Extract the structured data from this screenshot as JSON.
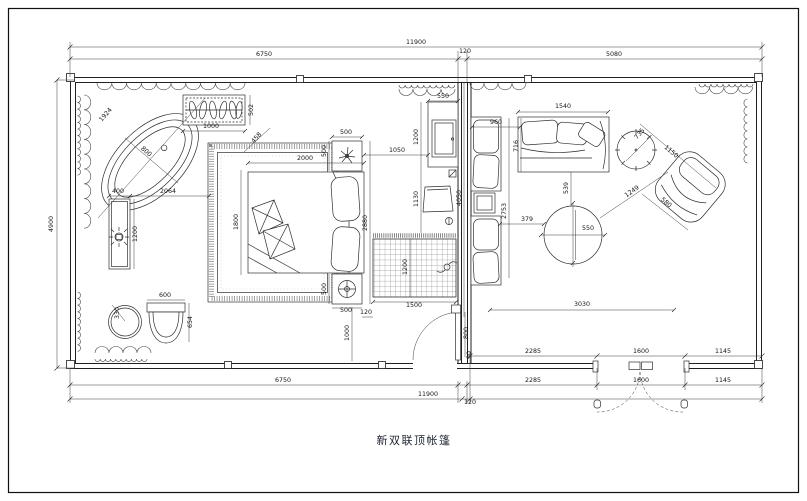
{
  "drawing": {
    "title": "新双联顶帐篷",
    "type": "floor-plan"
  },
  "colors": {
    "line": "#232323",
    "dim_text": "#141414",
    "texture": "#8a8a8a",
    "background": "#ffffff"
  },
  "icons": {
    "lamp": "circle-cross",
    "plant": "leaf-burst",
    "faucet": "sparkle",
    "ceiling-fan": "circle-blades",
    "drain": "small-circle",
    "outlet": "small-square",
    "floor-socket": "small-circle"
  },
  "overall_dimensions": {
    "total_width": "11900",
    "left_unit": "6750",
    "gap": "120",
    "right_unit": "5080",
    "depth": "4900"
  },
  "dimension_labels": [
    {
      "t": "11900",
      "x": 416,
      "y": 44,
      "r": 0
    },
    {
      "t": "6750",
      "x": 264,
      "y": 56,
      "r": 0
    },
    {
      "t": "120",
      "x": 465,
      "y": 53,
      "r": 0
    },
    {
      "t": "5080",
      "x": 614,
      "y": 56,
      "r": 0
    },
    {
      "t": "4900",
      "x": 53,
      "y": 224,
      "r": -90
    },
    {
      "t": "2285",
      "x": 533,
      "y": 353,
      "r": 0
    },
    {
      "t": "1600",
      "x": 641,
      "y": 353,
      "r": 0
    },
    {
      "t": "1145",
      "x": 723,
      "y": 353,
      "r": 0
    },
    {
      "t": "6750",
      "x": 283,
      "y": 382,
      "r": 0
    },
    {
      "t": "2285",
      "x": 533,
      "y": 382,
      "r": 0
    },
    {
      "t": "1600",
      "x": 641,
      "y": 382,
      "r": 0
    },
    {
      "t": "1145",
      "x": 723,
      "y": 382,
      "r": 0
    },
    {
      "t": "11900",
      "x": 428,
      "y": 396,
      "r": 0
    },
    {
      "t": "120",
      "x": 470,
      "y": 404,
      "r": 0
    },
    {
      "t": "1924",
      "x": 107,
      "y": 116,
      "r": -49
    },
    {
      "t": "800",
      "x": 145,
      "y": 153,
      "r": 41
    },
    {
      "t": "1000",
      "x": 211,
      "y": 128,
      "r": 0
    },
    {
      "t": "502",
      "x": 253,
      "y": 110,
      "r": -90
    },
    {
      "t": "400",
      "x": 118,
      "y": 193,
      "r": 0
    },
    {
      "t": "2064",
      "x": 168,
      "y": 193,
      "r": 0
    },
    {
      "t": "1200",
      "x": 137,
      "y": 234,
      "r": -90
    },
    {
      "t": "330",
      "x": 119,
      "y": 313,
      "r": -90
    },
    {
      "t": "600",
      "x": 165,
      "y": 297,
      "r": 0
    },
    {
      "t": "654",
      "x": 192,
      "y": 322,
      "r": -90
    },
    {
      "t": "1800",
      "x": 238,
      "y": 222,
      "r": -90
    },
    {
      "t": "458",
      "x": 258,
      "y": 139,
      "r": -49
    },
    {
      "t": "2000",
      "x": 305,
      "y": 160,
      "r": 0
    },
    {
      "t": "500",
      "x": 346,
      "y": 134,
      "r": 0
    },
    {
      "t": "500",
      "x": 326,
      "y": 151,
      "r": -90
    },
    {
      "t": "1050",
      "x": 397,
      "y": 152,
      "r": 0
    },
    {
      "t": "550",
      "x": 443,
      "y": 98,
      "r": 0
    },
    {
      "t": "1200",
      "x": 418,
      "y": 137,
      "r": -90
    },
    {
      "t": "1130",
      "x": 418,
      "y": 199,
      "r": -90
    },
    {
      "t": "2880",
      "x": 367,
      "y": 223,
      "r": -90
    },
    {
      "t": "500",
      "x": 326,
      "y": 289,
      "r": -90
    },
    {
      "t": "500",
      "x": 346,
      "y": 312,
      "r": 0
    },
    {
      "t": "1500",
      "x": 414,
      "y": 307,
      "r": 0
    },
    {
      "t": "1200",
      "x": 407,
      "y": 267,
      "r": -90
    },
    {
      "t": "120",
      "x": 366,
      "y": 314,
      "r": 0
    },
    {
      "t": "1000",
      "x": 349,
      "y": 333,
      "r": -90
    },
    {
      "t": "800",
      "x": 468,
      "y": 333,
      "r": -90
    },
    {
      "t": "90",
      "x": 471,
      "y": 355,
      "r": -90
    },
    {
      "t": "960",
      "x": 496,
      "y": 124,
      "r": 0
    },
    {
      "t": "1540",
      "x": 563,
      "y": 108,
      "r": 0
    },
    {
      "t": "716",
      "x": 518,
      "y": 146,
      "r": -90
    },
    {
      "t": "4050",
      "x": 461,
      "y": 198,
      "r": -90
    },
    {
      "t": "2753",
      "x": 506,
      "y": 211,
      "r": -90
    },
    {
      "t": "539",
      "x": 568,
      "y": 188,
      "r": -90
    },
    {
      "t": "379",
      "x": 527,
      "y": 221,
      "r": 0
    },
    {
      "t": "550",
      "x": 588,
      "y": 230,
      "r": 0
    },
    {
      "t": "1249",
      "x": 633,
      "y": 193,
      "r": -35
    },
    {
      "t": "735",
      "x": 641,
      "y": 135,
      "r": -50
    },
    {
      "t": "1150",
      "x": 670,
      "y": 153,
      "r": 40
    },
    {
      "t": "580",
      "x": 665,
      "y": 204,
      "r": 40
    },
    {
      "t": "3030",
      "x": 582,
      "y": 306,
      "r": 0
    }
  ]
}
